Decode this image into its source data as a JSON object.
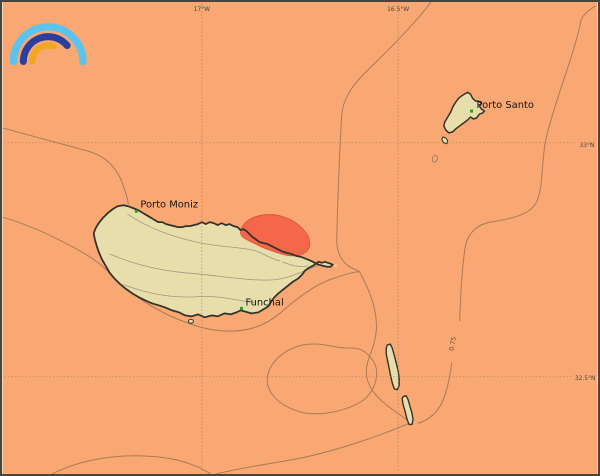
{
  "logo": {
    "name": "rainbow-arcs-logo"
  },
  "axis": {
    "top": [
      "17°W",
      "16.5°W"
    ],
    "right": [
      "33°N",
      "32.5°N"
    ]
  },
  "labels": {
    "porto_moniz": "Porto Moniz",
    "funchal": "Funchal",
    "porto_santo": "Porto Santo",
    "contour": "0.75"
  },
  "colors": {
    "sea": "#F9A873",
    "land": "#E8DEAC",
    "coast": "#33332B",
    "warning": "#F4674B",
    "warning_edge": "#DE4F33",
    "contour": "#A57856",
    "grid": "#A97C5F",
    "interior": "#8F8F7A",
    "marker": "#21A121",
    "logo_outer": "#5BC4EE",
    "logo_middle": "#2A3F9B",
    "logo_inner": "#F2A71F"
  }
}
